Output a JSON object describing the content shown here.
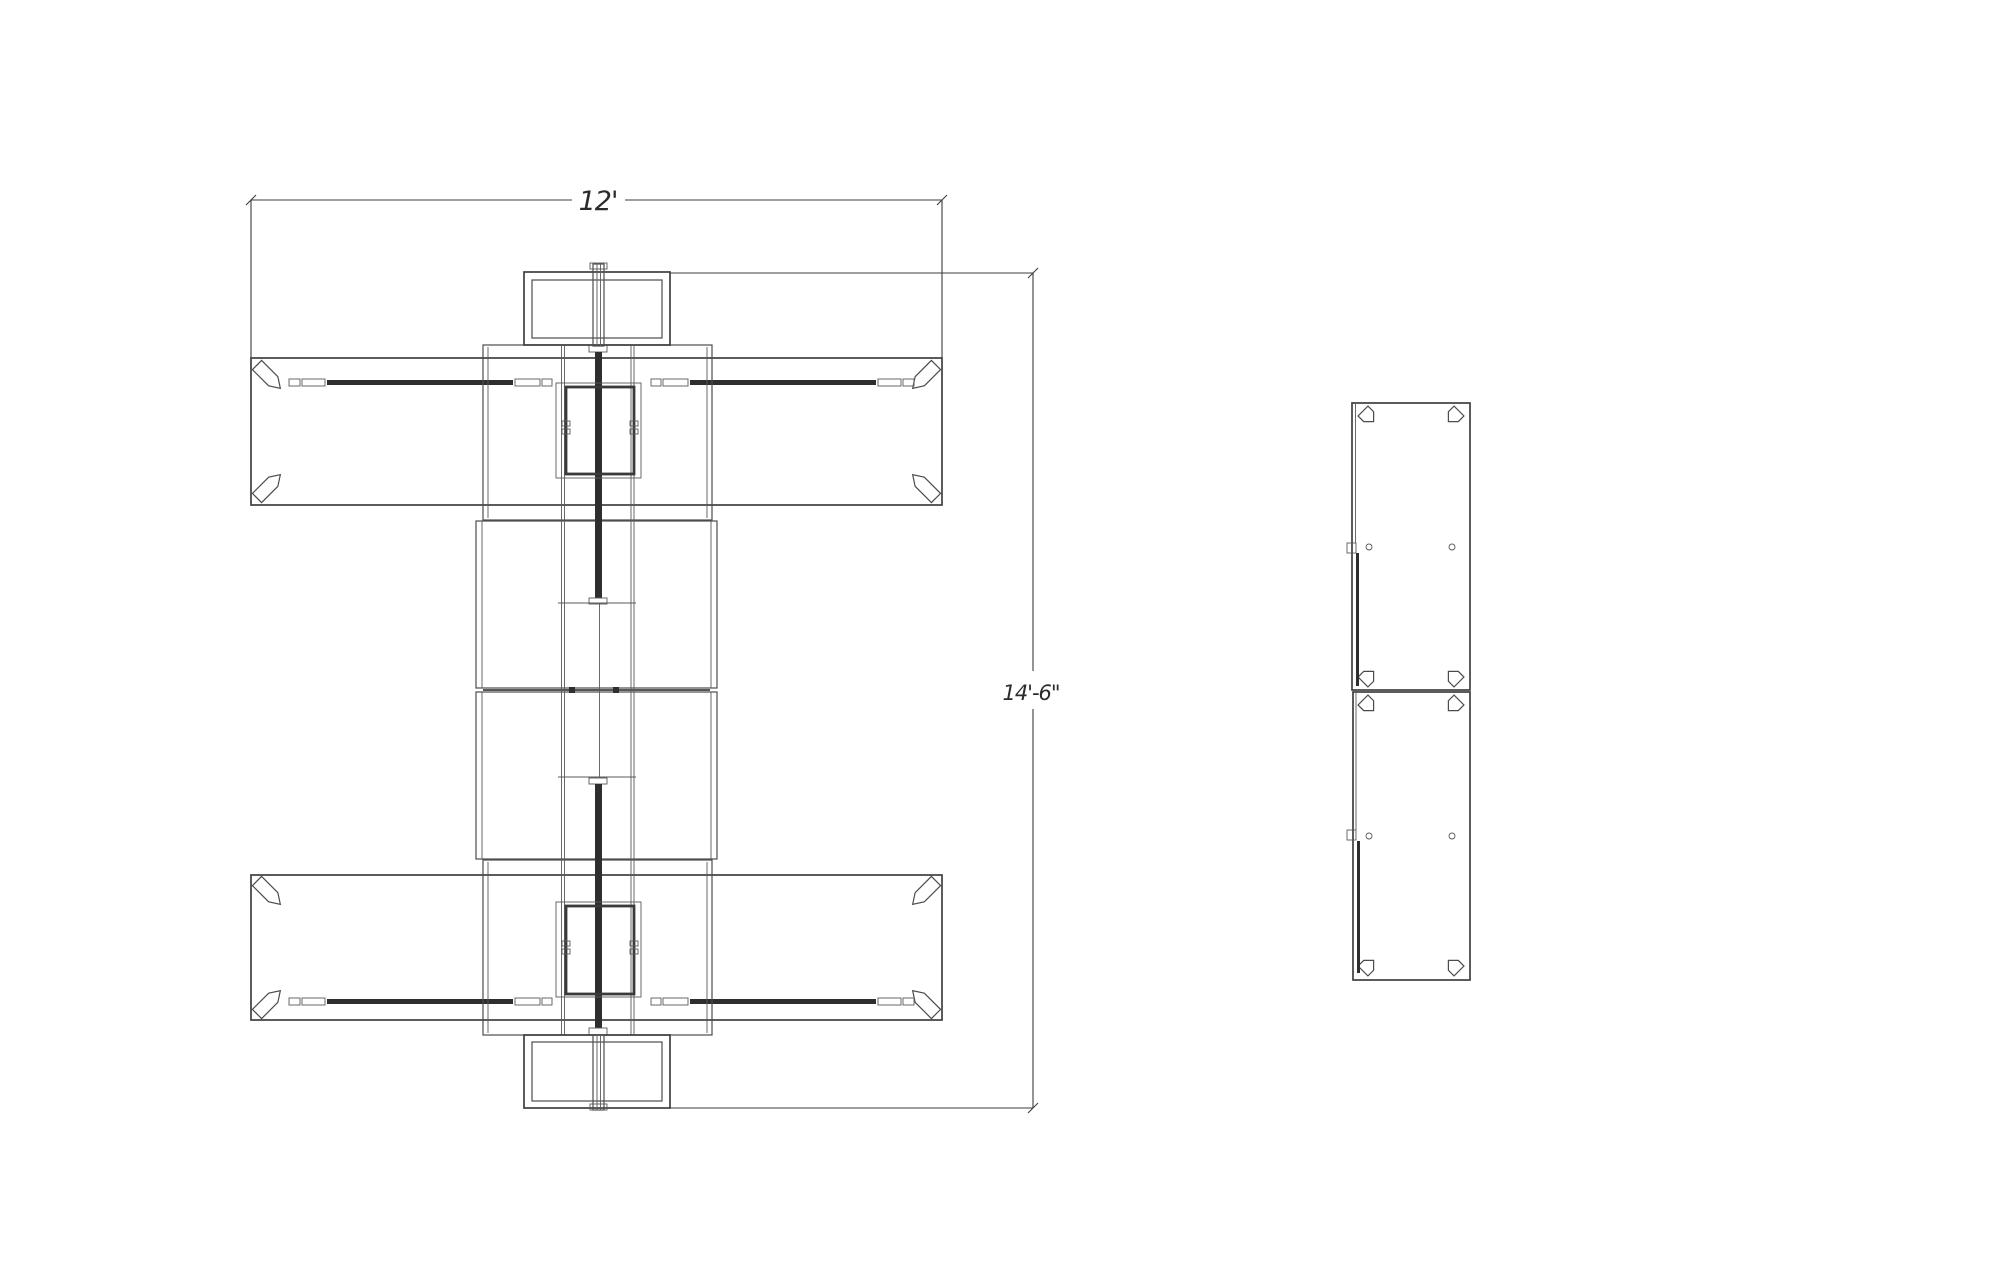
{
  "drawing": {
    "dimensions": {
      "width_label": "12'",
      "height_label": "14'-6\""
    },
    "colors": {
      "background": "#ffffff",
      "line": "#4c4c4c",
      "dark_line": "#2e2e2e"
    }
  }
}
